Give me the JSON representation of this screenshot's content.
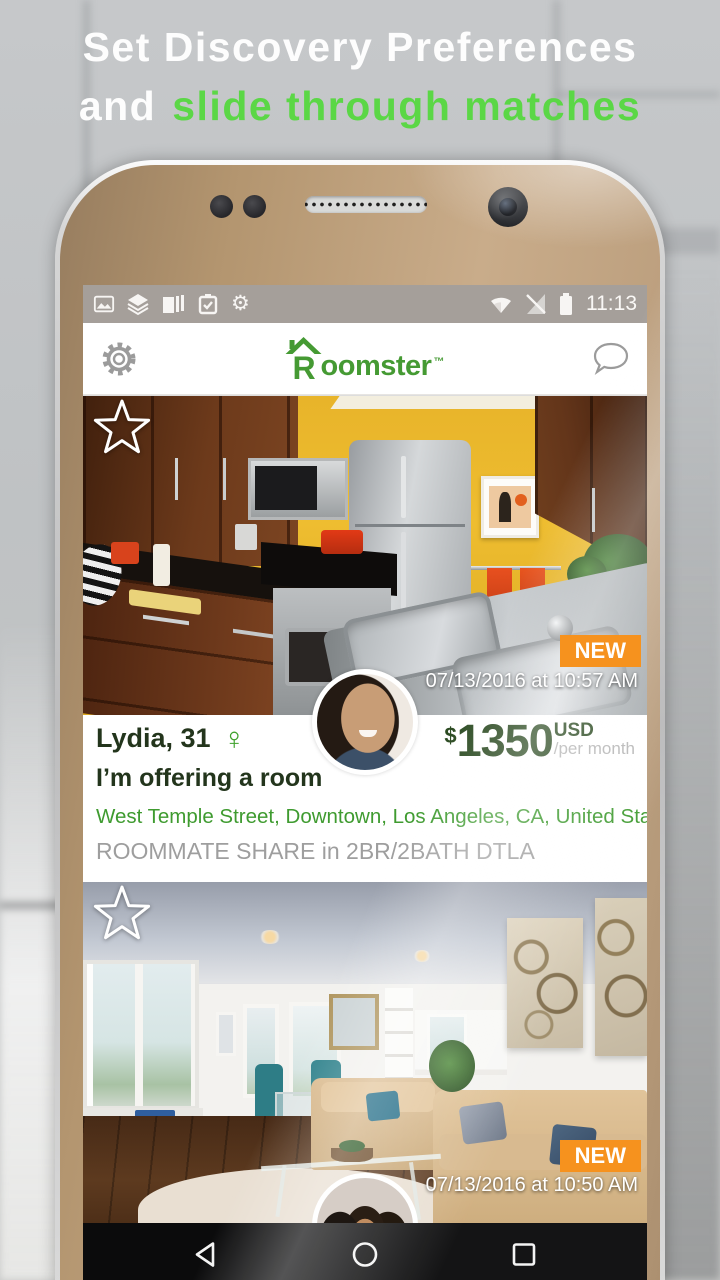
{
  "headline": {
    "line1": "Set Discovery Preferences",
    "line2_white": "and",
    "line2_green": "slide through matches"
  },
  "status_bar": {
    "time": "11:13",
    "gear_glyph": "⚙"
  },
  "header": {
    "logo_r": "R",
    "logo_rest": "oomster",
    "logo_tm": "™"
  },
  "cards": [
    {
      "badge": "NEW",
      "posted": "07/13/2016 at 10:57 AM",
      "name": "Lydia, 31",
      "gender_symbol": "♀",
      "price_symbol": "$",
      "price": "1350",
      "currency": "USD",
      "per": "/per month",
      "offer_type": "I’m offering a room",
      "location": "West Temple Street, Downtown, Los Angeles, CA, United States",
      "title": "ROOMMATE SHARE in 2BR/2BATH DTLA"
    },
    {
      "badge": "NEW",
      "posted": "07/13/2016 at 10:50 AM"
    }
  ],
  "colors": {
    "brand_green": "#459a33",
    "headline_green": "#5bd746",
    "badge_orange": "#f6921e",
    "price_green": "#2b4a21",
    "location_green": "#3f9b30",
    "muted_gray": "#9e9e9e",
    "phone_gold": "#c9ac8a"
  }
}
